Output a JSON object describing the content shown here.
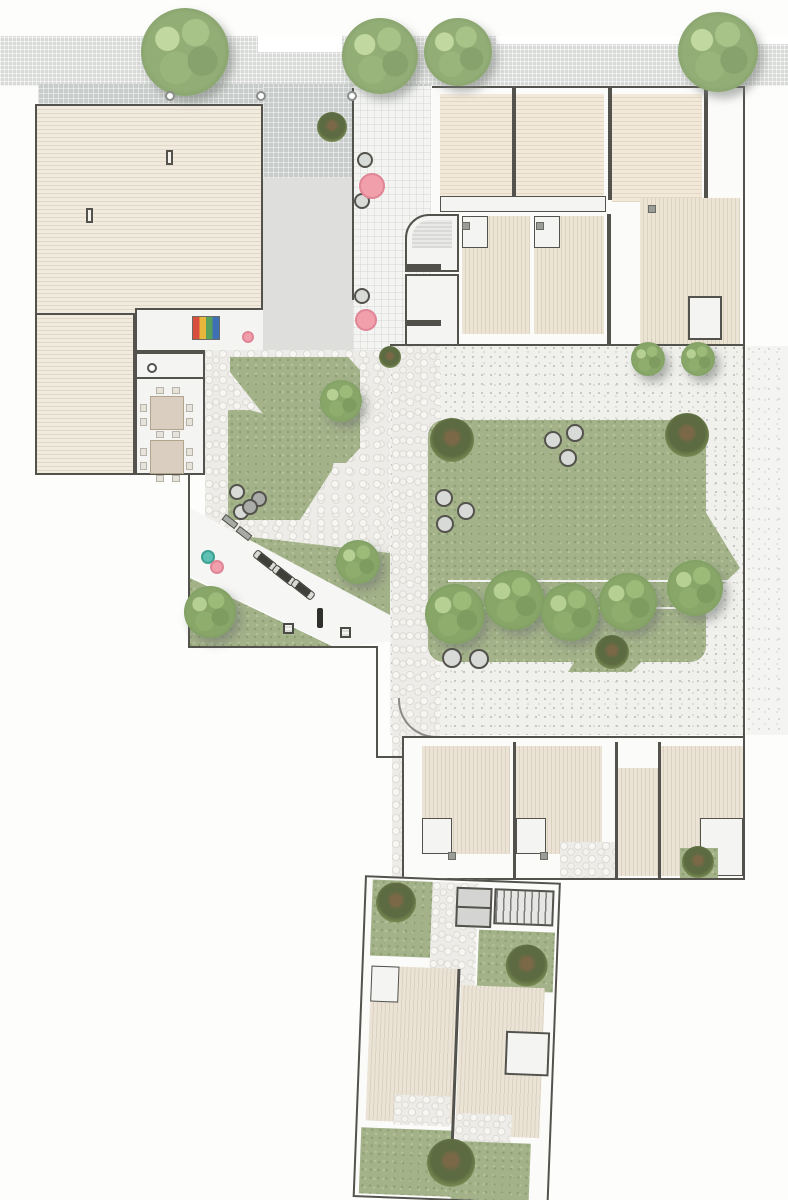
{
  "meta": {
    "title": "Residential complex site plan - top view",
    "canvas_width": 788,
    "canvas_height": 1200,
    "description": "Architectural site plan showing a street sidewalk with trees, a timber roof deck, entry plaza with umbrella tables, apartment units with wooden terraces, a central lawn courtyard with tree row, playground room, outdoor gym strip and private gardens"
  },
  "palette": {
    "wall": "#53524d",
    "deck_light": "#f0e8da",
    "deck_warm": "#e9dfcc",
    "plaza_dark": "#c8ccca",
    "plaza_light": "#dedfdd",
    "walkway": "#f4f5f3",
    "sidewalk": "#d8dad8",
    "gravel": "#f0f0ed",
    "cobble": "#edece8",
    "lawn": "#a3b289",
    "tree_green": "#88a668",
    "shrub_green": "#5c6b41",
    "pink_accent": "#f09fab",
    "teal_accent": "#5fc0b4",
    "stool_gray": "#d8dad7"
  },
  "counts": {
    "street_trees": 4,
    "bollards": 3,
    "pink_umbrella_tables": 3,
    "teal_tables": 1,
    "lawn_stools": 8,
    "courtyard_tree_row": 5,
    "gym_machines": 3,
    "club_tables": 2
  },
  "features": [
    {
      "target": "plan",
      "class": "tree t-street",
      "name": "street-tree",
      "items": [
        {
          "x": 185,
          "y": 52,
          "r": 44
        },
        {
          "x": 380,
          "y": 56,
          "r": 38
        },
        {
          "x": 458,
          "y": 52,
          "r": 34
        },
        {
          "x": 718,
          "y": 52,
          "r": 40
        }
      ]
    },
    {
      "target": "plan",
      "class": "bollard",
      "name": "bollard",
      "items": [
        {
          "x": 170,
          "y": 96,
          "r": 5
        },
        {
          "x": 261,
          "y": 96,
          "r": 5
        },
        {
          "x": 352,
          "y": 96,
          "r": 5
        }
      ]
    },
    {
      "target": "plan",
      "class": "shrub",
      "name": "planter-shrub",
      "items": [
        {
          "x": 332,
          "y": 127,
          "r": 15
        },
        {
          "x": 390,
          "y": 357,
          "r": 11
        }
      ]
    },
    {
      "target": "plan",
      "class": "stool",
      "name": "plaza-side-table",
      "items": [
        {
          "x": 365,
          "y": 160,
          "r": 8
        },
        {
          "x": 362,
          "y": 201,
          "r": 8
        },
        {
          "x": 362,
          "y": 296,
          "r": 8
        }
      ]
    },
    {
      "target": "plan",
      "class": "pinktbl",
      "name": "pink-umbrella-table",
      "items": [
        {
          "x": 372,
          "y": 186,
          "r": 13
        },
        {
          "x": 366,
          "y": 320,
          "r": 11
        },
        {
          "x": 248,
          "y": 337,
          "r": 6
        }
      ]
    },
    {
      "target": "plan",
      "class": "tree",
      "name": "gravel-tree",
      "items": [
        {
          "x": 648,
          "y": 359,
          "r": 17
        },
        {
          "x": 698,
          "y": 359,
          "r": 17
        }
      ]
    },
    {
      "target": "plan",
      "class": "shrub",
      "name": "lawn-corner-shrub",
      "items": [
        {
          "x": 452,
          "y": 440,
          "r": 22
        },
        {
          "x": 687,
          "y": 435,
          "r": 22
        },
        {
          "x": 612,
          "y": 652,
          "r": 17
        }
      ]
    },
    {
      "target": "plan",
      "class": "tree",
      "name": "courtyard-row-tree",
      "items": [
        {
          "x": 455,
          "y": 614,
          "r": 30
        },
        {
          "x": 514,
          "y": 600,
          "r": 30
        },
        {
          "x": 570,
          "y": 612,
          "r": 29
        },
        {
          "x": 628,
          "y": 602,
          "r": 29
        },
        {
          "x": 695,
          "y": 588,
          "r": 28
        }
      ]
    },
    {
      "target": "plan",
      "class": "stool",
      "name": "lawn-stool",
      "items": [
        {
          "x": 553,
          "y": 440,
          "r": 9
        },
        {
          "x": 575,
          "y": 433,
          "r": 9
        },
        {
          "x": 568,
          "y": 458,
          "r": 9
        },
        {
          "x": 444,
          "y": 498,
          "r": 9
        },
        {
          "x": 466,
          "y": 511,
          "r": 9
        },
        {
          "x": 445,
          "y": 524,
          "r": 9
        },
        {
          "x": 452,
          "y": 658,
          "r": 10
        },
        {
          "x": 479,
          "y": 659,
          "r": 10
        }
      ]
    },
    {
      "target": "plan",
      "class": "tree",
      "name": "upper-garden-tree",
      "items": [
        {
          "x": 341,
          "y": 401,
          "r": 21
        }
      ]
    },
    {
      "target": "plan",
      "class": "stool",
      "name": "upper-garden-stool",
      "items": [
        {
          "x": 237,
          "y": 492,
          "r": 8
        },
        {
          "x": 259,
          "y": 499,
          "r": 8,
          "variant": "dark"
        },
        {
          "x": 241,
          "y": 512,
          "r": 8
        }
      ]
    },
    {
      "target": "plan",
      "class": "stool",
      "name": "gym-stool",
      "items": [
        {
          "x": 250,
          "y": 507,
          "r": 8,
          "variant": "dark"
        }
      ]
    },
    {
      "target": "plan",
      "class": "tealtbl",
      "name": "teal-table",
      "items": [
        {
          "x": 208,
          "y": 557,
          "r": 7
        }
      ]
    },
    {
      "target": "plan",
      "class": "pinktbl",
      "name": "gym-pink-table",
      "items": [
        {
          "x": 217,
          "y": 567,
          "r": 7
        }
      ]
    },
    {
      "target": "plan",
      "class": "lounger",
      "name": "sun-lounger",
      "rot": 38,
      "w": 16,
      "h": 7,
      "items": [
        {
          "x": 222,
          "y": 518
        },
        {
          "x": 236,
          "y": 530
        }
      ]
    },
    {
      "target": "plan",
      "class": "machine",
      "name": "gym-machine",
      "rot": 38,
      "w": 26,
      "h": 9,
      "items": [
        {
          "x": 252,
          "y": 556
        },
        {
          "x": 271,
          "y": 571
        },
        {
          "x": 290,
          "y": 585
        }
      ]
    },
    {
      "target": "plan",
      "class": "mat",
      "name": "gym-mat",
      "w": 11,
      "h": 11,
      "items": [
        {
          "x": 283,
          "y": 623
        },
        {
          "x": 340,
          "y": 627
        }
      ]
    },
    {
      "target": "plan",
      "class": "gympost",
      "name": "pullup-post",
      "w": 6,
      "h": 20,
      "items": [
        {
          "x": 317,
          "y": 608
        }
      ]
    },
    {
      "target": "plan",
      "class": "tree",
      "name": "gym-tree",
      "items": [
        {
          "x": 358,
          "y": 562,
          "r": 22
        },
        {
          "x": 210,
          "y": 612,
          "r": 26
        }
      ]
    },
    {
      "target": "plan",
      "class": "ctable",
      "name": "club-table",
      "w": 34,
      "h": 34,
      "items": [
        {
          "x": 150,
          "y": 396
        },
        {
          "x": 150,
          "y": 440
        }
      ]
    },
    {
      "target": "plan",
      "class": "chair",
      "name": "club-chair",
      "w": 8,
      "h": 7,
      "items": [
        {
          "x": 156,
          "y": 387
        },
        {
          "x": 172,
          "y": 387
        },
        {
          "x": 156,
          "y": 431
        },
        {
          "x": 172,
          "y": 431
        },
        {
          "x": 140,
          "y": 404,
          "w": 7,
          "h": 8
        },
        {
          "x": 140,
          "y": 418,
          "w": 7,
          "h": 8
        },
        {
          "x": 186,
          "y": 404,
          "w": 7,
          "h": 8
        },
        {
          "x": 186,
          "y": 418,
          "w": 7,
          "h": 8
        },
        {
          "x": 156,
          "y": 475
        },
        {
          "x": 172,
          "y": 475
        },
        {
          "x": 140,
          "y": 448,
          "w": 7,
          "h": 8
        },
        {
          "x": 140,
          "y": 462,
          "w": 7,
          "h": 8
        },
        {
          "x": 186,
          "y": 448,
          "w": 7,
          "h": 8
        },
        {
          "x": 186,
          "y": 462,
          "w": 7,
          "h": 8
        }
      ]
    },
    {
      "target": "plan",
      "class": "shrub",
      "name": "mid-row-garden-shrub",
      "items": [
        {
          "x": 698,
          "y": 862,
          "r": 16
        }
      ]
    },
    {
      "target": "plan",
      "class": "skylight",
      "name": "deck-skylight",
      "w": 7,
      "h": 15,
      "items": [
        {
          "x": 166,
          "y": 150
        },
        {
          "x": 86,
          "y": 208
        }
      ]
    },
    {
      "target": "plan",
      "class": "lbl",
      "name": "unit-tiny-label",
      "w": 34,
      "h": 6,
      "items": [
        {
          "x": 407,
          "y": 264
        },
        {
          "x": 407,
          "y": 320
        }
      ]
    },
    {
      "target": "plan",
      "class": "fixture",
      "name": "deck-fixture",
      "w": 8,
      "h": 8,
      "items": [
        {
          "x": 462,
          "y": 222
        },
        {
          "x": 536,
          "y": 222
        },
        {
          "x": 448,
          "y": 852
        },
        {
          "x": 540,
          "y": 852
        },
        {
          "x": 648,
          "y": 205
        }
      ]
    },
    {
      "target": "bottom-block",
      "class": "shrub",
      "name": "bottom-garden-shrub",
      "items": [
        {
          "x": 30,
          "y": 24,
          "r": 20
        },
        {
          "x": 163,
          "y": 82,
          "r": 21
        },
        {
          "x": 95,
          "y": 282,
          "r": 24
        }
      ]
    }
  ]
}
